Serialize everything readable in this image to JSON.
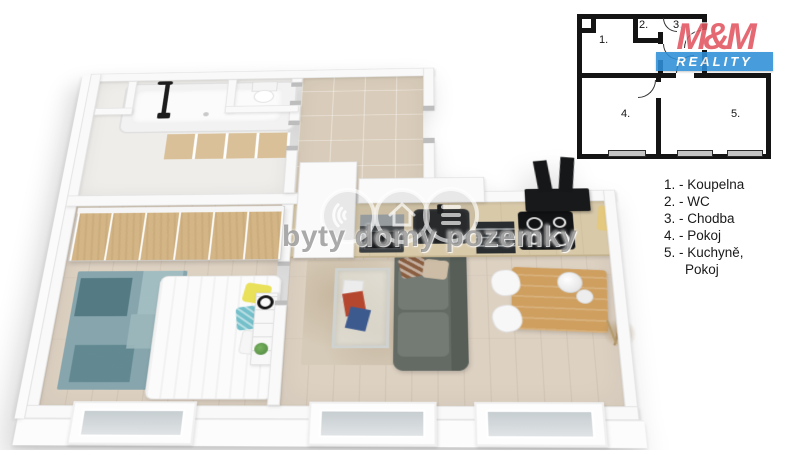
{
  "image": {
    "type": "3d-floor-plan-render",
    "background": "#ffffff"
  },
  "watermark": {
    "text": "byty domy pozemky",
    "icon_names": [
      "signal-arcs-icon",
      "house-icon",
      "stack-icon"
    ]
  },
  "brand": {
    "name": "M&M",
    "tagline": "REALITY",
    "red": "#e25560",
    "blue": "#2e8fd8"
  },
  "legend": {
    "lines": [
      "1. - Koupelna",
      "2. - WC",
      "3. - Chodba",
      "4. - Pokoj",
      "5. - Kuchyně,",
      "Pokoj"
    ]
  },
  "schematic": {
    "labels": [
      "1.",
      "2.",
      "3.",
      "4.",
      "5."
    ],
    "wall_color": "#141414",
    "window_color": "#c4c4c4"
  },
  "palette": {
    "floor_wood": "#ddd1c2",
    "hall_tile": "#d9ccba",
    "wardrobe_wood": "#d3b586",
    "counter_wood": "#d8c9a9",
    "rug_teal": "#86a5ad",
    "rug_beige": "#d6cbb8",
    "sofa_gray": "#646b65",
    "dining_wood": "#cf9f5f",
    "appliance_black": "#17181a"
  }
}
